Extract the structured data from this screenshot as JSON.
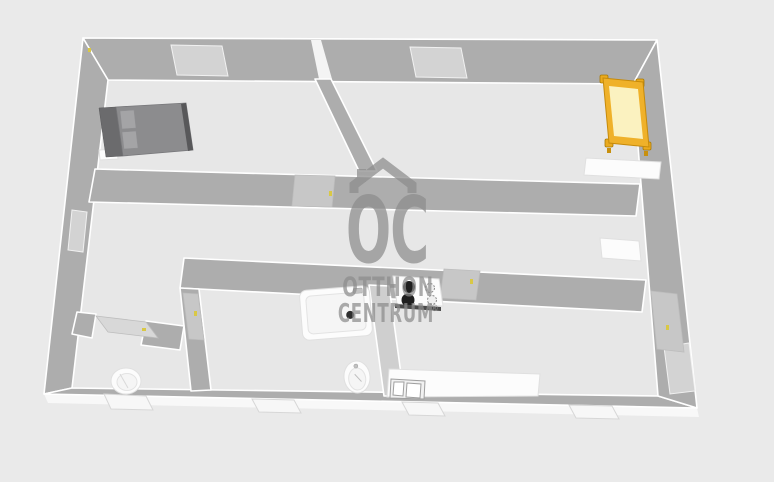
{
  "watermark": {
    "monogram": "OC",
    "line1": "OTTHON",
    "line2": "CENTRUM",
    "registered_mark": "®"
  },
  "colors": {
    "background": "#eaeaea",
    "floor": "#e7e7e7",
    "wall": "#adadad",
    "wall_light": "#cfcfcf",
    "window": "#d3d3d3",
    "door": "#c7c7c7",
    "bed_gray": "#8c8c8e",
    "pillow_gray": "#a4a4a6",
    "bed_yellow_frame": "#efb12a",
    "bed_yellow_mattress": "#fbf2c0",
    "handle_yellow": "#d9c845",
    "burner_black": "#1f1f1f",
    "watermark_gray": "#8c8c8c"
  },
  "furniture": {
    "items": [
      "double-bed",
      "single-bed",
      "wall-shelf",
      "cabinet",
      "bathtub",
      "washbasin",
      "toilet",
      "cooktop",
      "kitchen-counter"
    ]
  }
}
